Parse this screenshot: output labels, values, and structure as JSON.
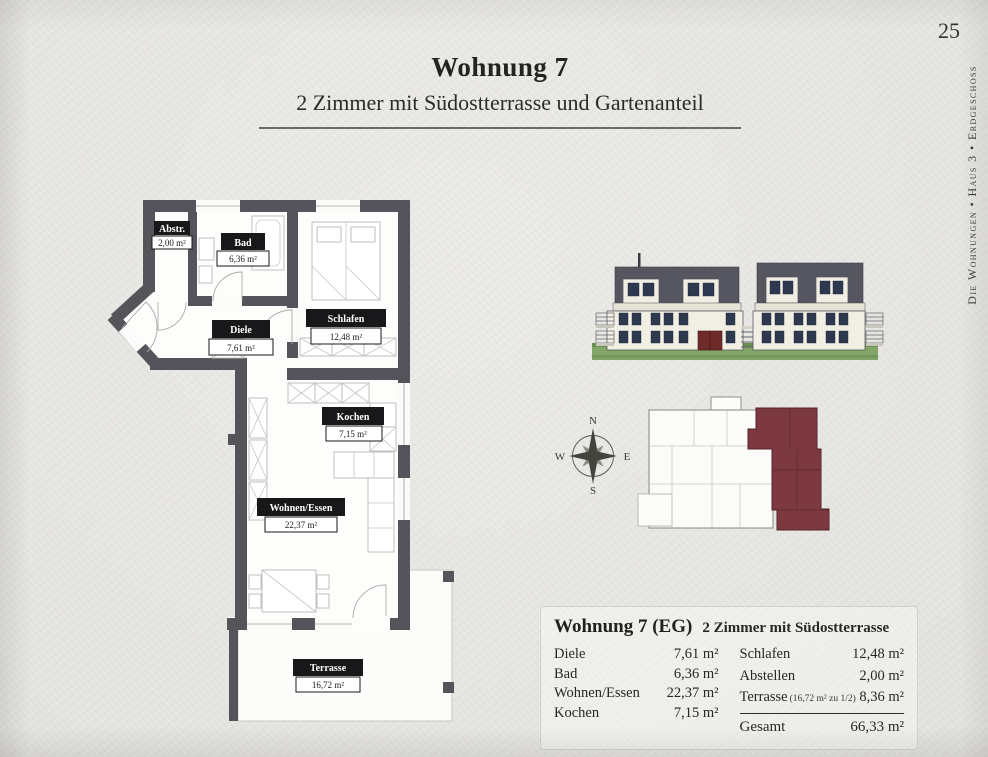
{
  "page": {
    "number": "25",
    "sidebar_text": "Die Wohnungen • Haus 3 • Erdgeschoss",
    "title": "Wohnung 7",
    "subtitle": "2 Zimmer mit Südostterrasse und Gartenanteil"
  },
  "floorplan": {
    "rooms": [
      {
        "name": "Abstr.",
        "area": "2,00 m²"
      },
      {
        "name": "Bad",
        "area": "6,36 m²"
      },
      {
        "name": "Diele",
        "area": "7,61 m²"
      },
      {
        "name": "Schlafen",
        "area": "12,48 m²"
      },
      {
        "name": "Kochen",
        "area": "7,15 m²"
      },
      {
        "name": "Wohnen/Essen",
        "area": "22,37 m²"
      },
      {
        "name": "Terrasse",
        "area": "16,72 m²"
      }
    ]
  },
  "compass": {
    "n": "N",
    "e": "E",
    "s": "S",
    "w": "W"
  },
  "summary": {
    "title": "Wohnung 7 (EG)",
    "subtitle": "2 Zimmer mit Südostterrasse",
    "left_rows": [
      {
        "label": "Diele",
        "value": "7,61 m²"
      },
      {
        "label": "Bad",
        "value": "6,36 m²"
      },
      {
        "label": "Wohnen/Essen",
        "value": "22,37 m²"
      },
      {
        "label": "Kochen",
        "value": "7,15 m²"
      }
    ],
    "right_rows": [
      {
        "label": "Schlafen",
        "note": "",
        "value": "12,48 m²"
      },
      {
        "label": "Abstellen",
        "note": "",
        "value": "2,00 m²"
      },
      {
        "label": "Terrasse",
        "note": "(16,72 m² zu 1/2)",
        "value": "8,36 m²"
      }
    ],
    "total_label": "Gesamt",
    "total_value": "66,33 m²"
  },
  "colors": {
    "paper": "#e8e7e3",
    "wall_gray": "#54545a",
    "label_black": "#18181a",
    "roof_gray": "#565660",
    "facade_cream": "#f1eee4",
    "window_navy": "#2e3950",
    "grass_green": "#83a567",
    "unit_red": "#7d3940",
    "door_red": "#6f2a2a"
  }
}
